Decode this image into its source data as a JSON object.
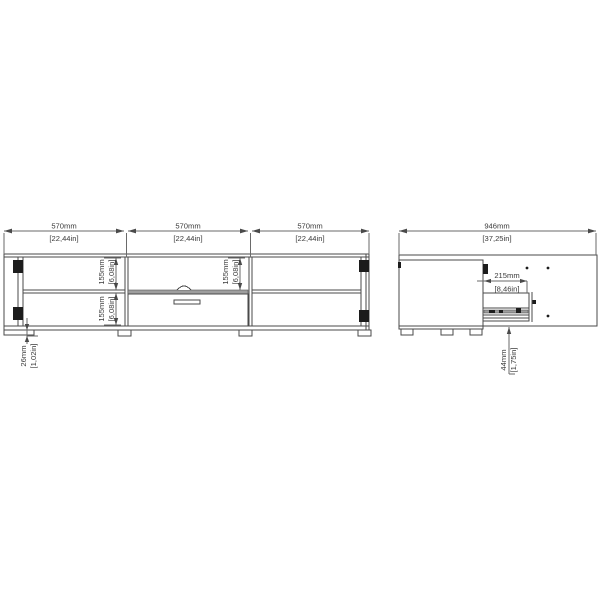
{
  "drawing_type": "furniture-dimension-diagram",
  "colors": {
    "background": "#ffffff",
    "line": "#4a4a4a",
    "hardware_black": "#1c1c1c",
    "drawer_band_gray": "#9e9e9e"
  },
  "front_view": {
    "width_dims": [
      {
        "mm": "570mm",
        "inch": "[22,44in]"
      },
      {
        "mm": "570mm",
        "inch": "[22,44in]"
      },
      {
        "mm": "570mm",
        "inch": "[22,44in]"
      }
    ],
    "shelf_dims": {
      "left_upper": {
        "mm": "155mm",
        "inch": "[6,08in]"
      },
      "left_lower": {
        "mm": "155mm",
        "inch": "[6,08in]"
      },
      "middle_upper": {
        "mm": "155mm",
        "inch": "[6,08in]"
      }
    },
    "plinth_dim": {
      "mm": "26mm",
      "inch": "[1,02in]"
    }
  },
  "side_view": {
    "overall_depth_dim": {
      "mm": "946mm",
      "inch": "[37,25in]"
    },
    "drawer_extension_dim": {
      "mm": "215mm",
      "inch": "[8,46in]"
    },
    "clearance_dim": {
      "mm": "44mm",
      "inch": "[1,75in]"
    }
  }
}
